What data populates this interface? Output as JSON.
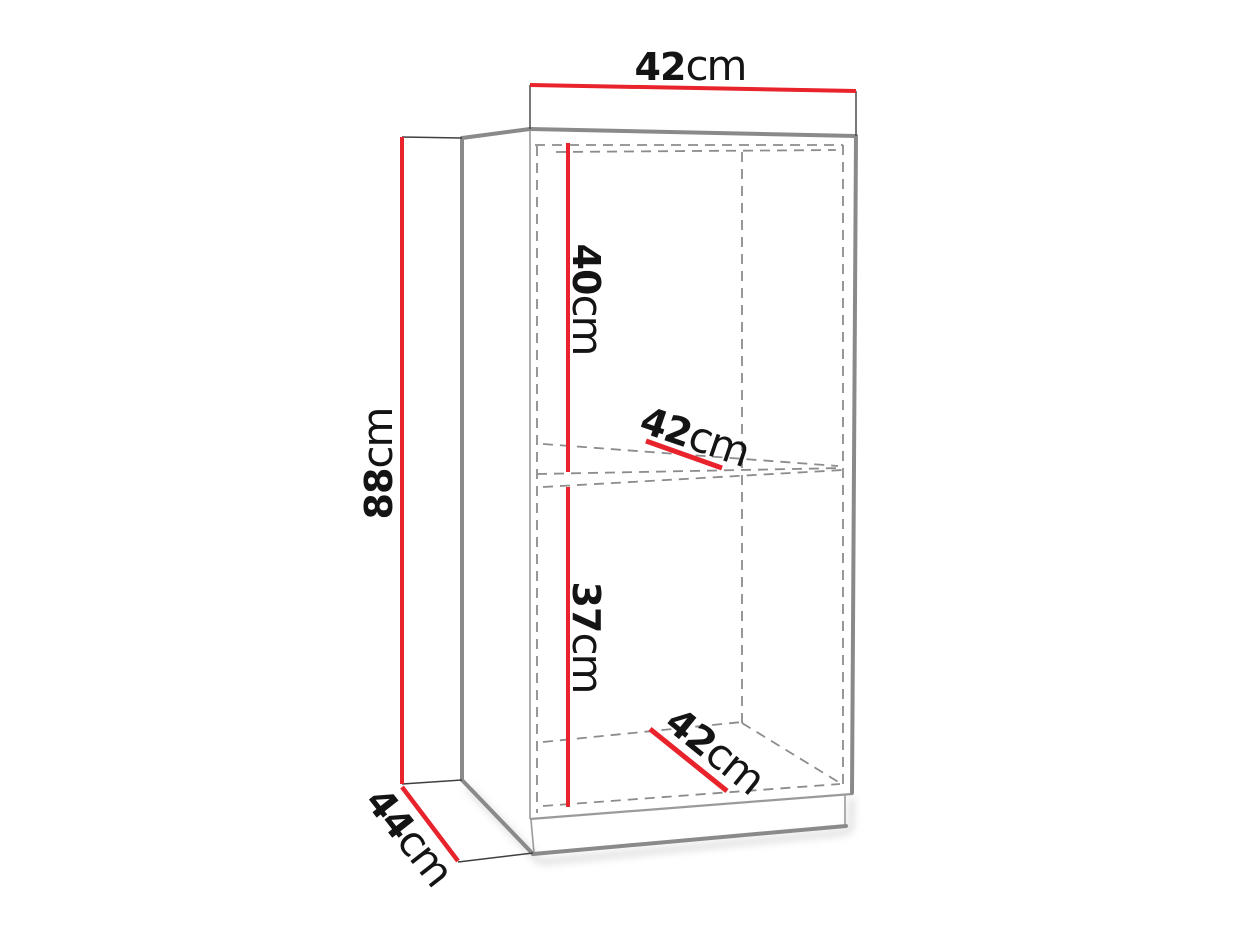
{
  "diagram": {
    "description": "Furniture cabinet technical drawing with outer and inner dimensions",
    "canvas": {
      "width": "1237",
      "height": "928",
      "background": "#ffffff"
    }
  },
  "colors": {
    "dimension_line": "#e8232b",
    "outline": "#8a8a8a",
    "edge_thin": "#9a9a9a",
    "tick": "#3f3f3f",
    "hidden_edge": "#8c8c8c",
    "label_text": "#141414",
    "shadow": "#b3b3b3"
  },
  "labels": {
    "width_top": {
      "value": "42",
      "unit": "cm"
    },
    "height_left": {
      "value": "88",
      "unit": "cm"
    },
    "depth_bottom": {
      "value": "44",
      "unit": "cm"
    },
    "upper_compartment_height": {
      "value": "40",
      "unit": "cm"
    },
    "upper_shelf_depth": {
      "value": "42",
      "unit": "cm"
    },
    "lower_compartment_height": {
      "value": "37",
      "unit": "cm"
    },
    "lower_shelf_depth": {
      "value": "42",
      "unit": "cm"
    }
  }
}
